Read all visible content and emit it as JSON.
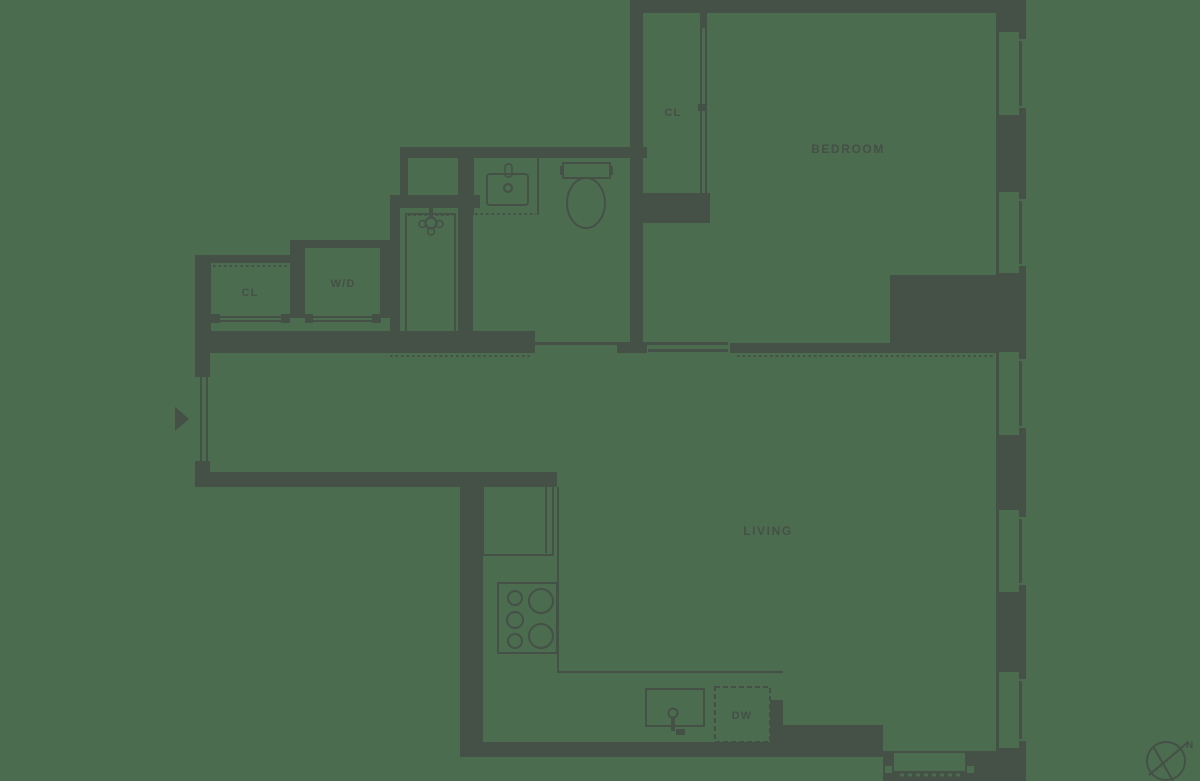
{
  "diagram": {
    "type": "apartment-floor-plan",
    "colors": {
      "background": "#4C6C50",
      "wall": "#455046",
      "label": "#455046"
    },
    "labels": {
      "bedroom": "BEDROOM",
      "living": "LIVING",
      "bedroom_closet": "CL",
      "hall_closet": "CL",
      "washer_dryer": "W/D",
      "dishwasher": "DW",
      "compass_north": "N"
    },
    "fixtures": [
      "entry-arrow",
      "shower",
      "vanity-sink",
      "toilet",
      "refrigerator",
      "range-burners",
      "kitchen-sink",
      "dishwasher",
      "window",
      "compass"
    ]
  }
}
